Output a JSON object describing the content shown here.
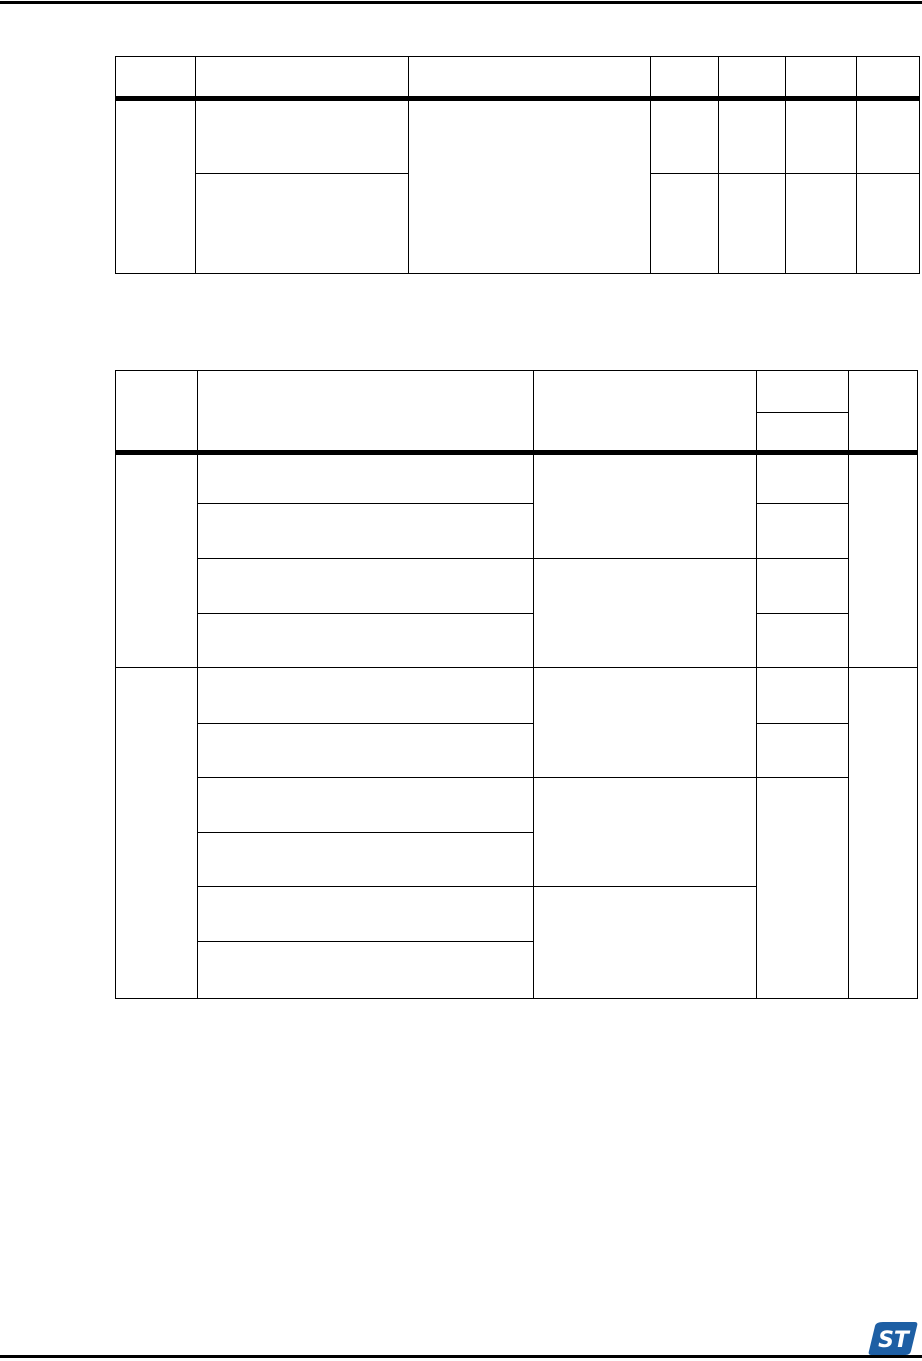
{
  "page": {
    "background": "#ffffff",
    "rule_color": "#000000"
  },
  "tables": {
    "table1": {
      "columns": 7,
      "header_rows": 1,
      "body_rows": 2,
      "content": "empty"
    },
    "table2": {
      "columns": 5,
      "header_rows": 2,
      "body_rows": 10,
      "content": "empty"
    }
  },
  "footer": {
    "logo": {
      "name": "st-logo",
      "color": "#1E5FA4",
      "text": "ST"
    }
  }
}
